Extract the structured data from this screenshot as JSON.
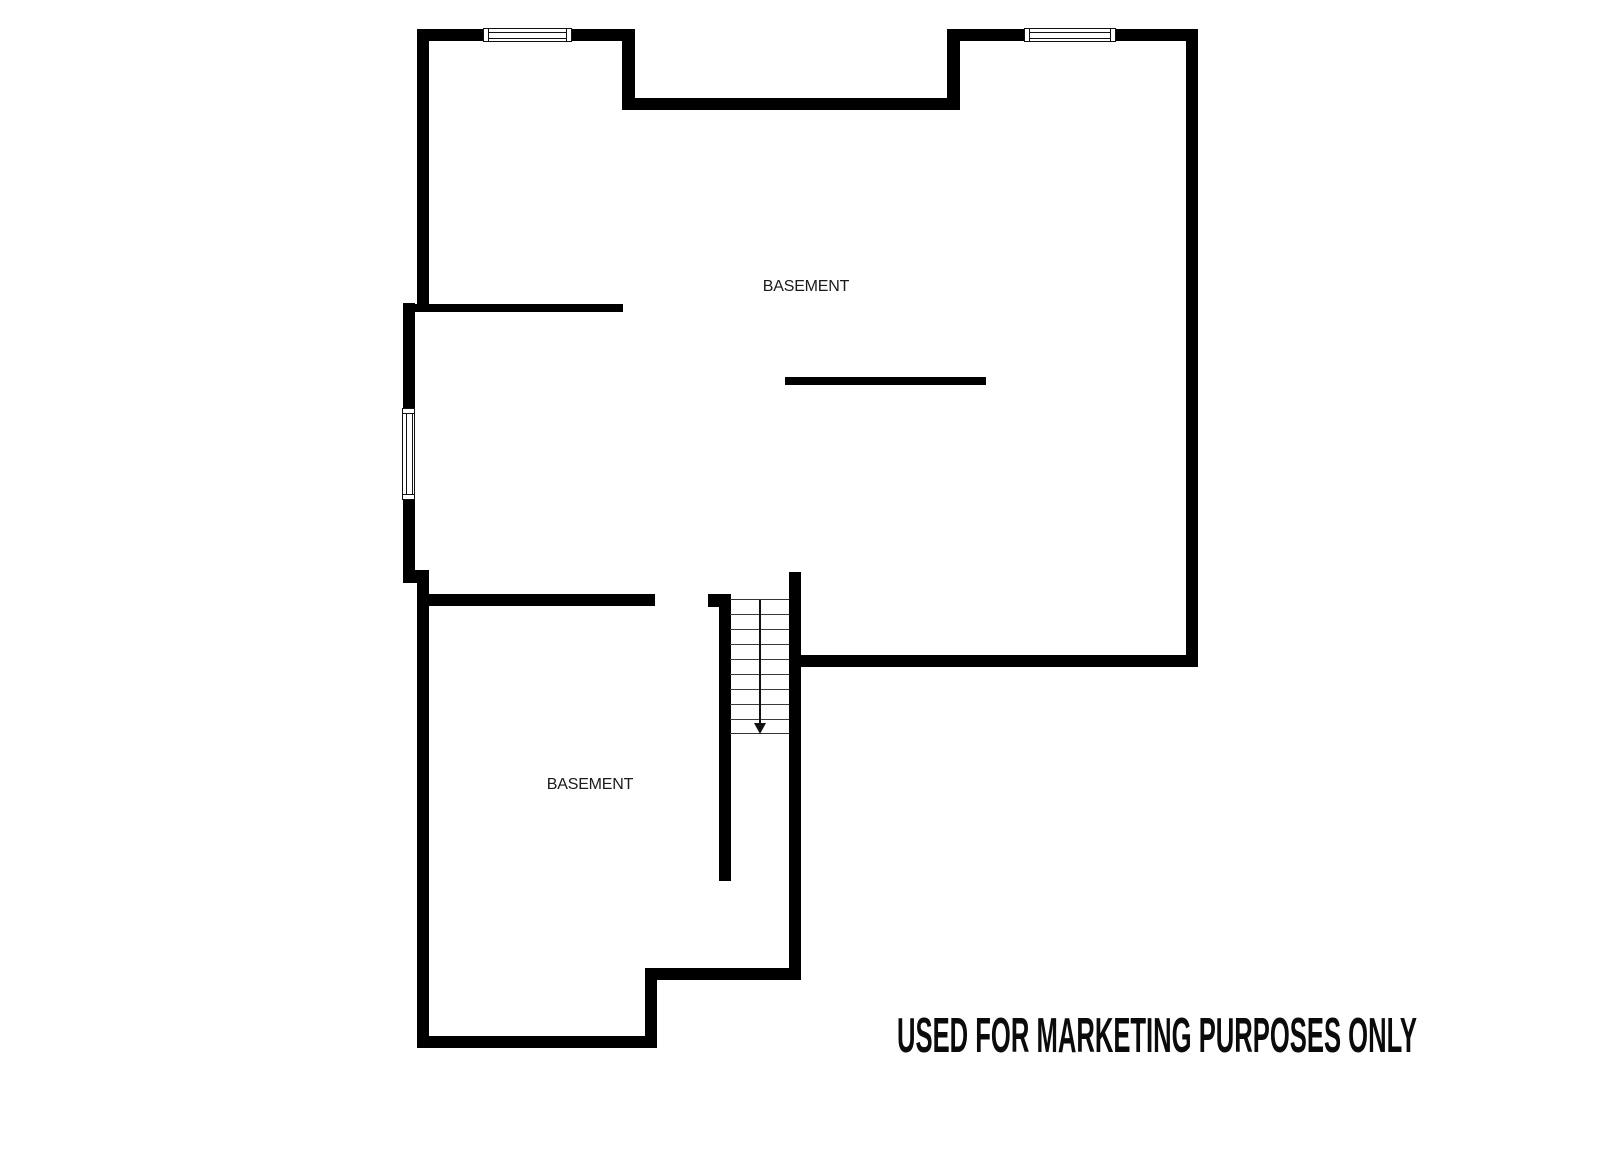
{
  "page": {
    "background": "#ffffff",
    "wall_color": "#000000"
  },
  "floorplan": {
    "room_labels": [
      {
        "text": "BASEMENT",
        "cx": 806,
        "cy": 287
      },
      {
        "text": "BASEMENT",
        "cx": 590,
        "cy": 785
      }
    ],
    "disclaimer": "USED FOR MARKETING PURPOSES ONLY",
    "walls": [
      {
        "name": "top-wall-left",
        "x": 418,
        "y": 29,
        "w": 217,
        "h": 12
      },
      {
        "name": "tower-a-right-wall",
        "x": 622,
        "y": 29,
        "w": 13,
        "h": 81
      },
      {
        "name": "recess-wall",
        "x": 622,
        "y": 98,
        "w": 338,
        "h": 12
      },
      {
        "name": "tower-b-left-wall",
        "x": 947,
        "y": 29,
        "w": 13,
        "h": 81
      },
      {
        "name": "top-wall-right",
        "x": 947,
        "y": 29,
        "w": 251,
        "h": 12
      },
      {
        "name": "right-wall",
        "x": 1186,
        "y": 29,
        "w": 12,
        "h": 638
      },
      {
        "name": "big-room-bottom-wall",
        "x": 789,
        "y": 655,
        "w": 409,
        "h": 12
      },
      {
        "name": "stair-right-wall",
        "x": 789,
        "y": 572,
        "w": 12,
        "h": 408
      },
      {
        "name": "step-wall",
        "x": 645,
        "y": 968,
        "w": 156,
        "h": 12
      },
      {
        "name": "lower-right-wall",
        "x": 645,
        "y": 968,
        "w": 12,
        "h": 80
      },
      {
        "name": "bottom-wall",
        "x": 417,
        "y": 1036,
        "w": 240,
        "h": 12
      },
      {
        "name": "lower-left-wall",
        "x": 417,
        "y": 570,
        "w": 12,
        "h": 478
      },
      {
        "name": "left-jog-cap",
        "x": 403,
        "y": 570,
        "w": 26,
        "h": 13
      },
      {
        "name": "window-wall-left",
        "x": 403,
        "y": 303,
        "w": 12,
        "h": 280
      },
      {
        "name": "tower-a-left-wall",
        "x": 417,
        "y": 29,
        "w": 12,
        "h": 283
      },
      {
        "name": "interior-wall-upper",
        "x": 412,
        "y": 304,
        "w": 211,
        "h": 8
      },
      {
        "name": "interior-wall-lower",
        "x": 424,
        "y": 594,
        "w": 231,
        "h": 12
      },
      {
        "name": "stair-stub-cap",
        "x": 708,
        "y": 594,
        "w": 22,
        "h": 13
      },
      {
        "name": "stair-corridor-wall",
        "x": 719,
        "y": 594,
        "w": 12,
        "h": 287
      }
    ],
    "half_wall": {
      "name": "half-wall",
      "x": 785,
      "y": 377,
      "w": 201,
      "h": 8
    },
    "windows": [
      {
        "name": "window-top-left",
        "x": 483,
        "y": 28,
        "w": 89,
        "h": 14,
        "orient": "h"
      },
      {
        "name": "window-top-right",
        "x": 1024,
        "y": 28,
        "w": 92,
        "h": 14,
        "orient": "h"
      },
      {
        "name": "window-left",
        "x": 402,
        "y": 408,
        "w": 13,
        "h": 92,
        "orient": "v"
      }
    ],
    "stairs": {
      "x": 730,
      "y": 599,
      "w": 59,
      "h": 135,
      "tread_spacing": 15,
      "inner_lines": 8,
      "direction": "down"
    }
  }
}
